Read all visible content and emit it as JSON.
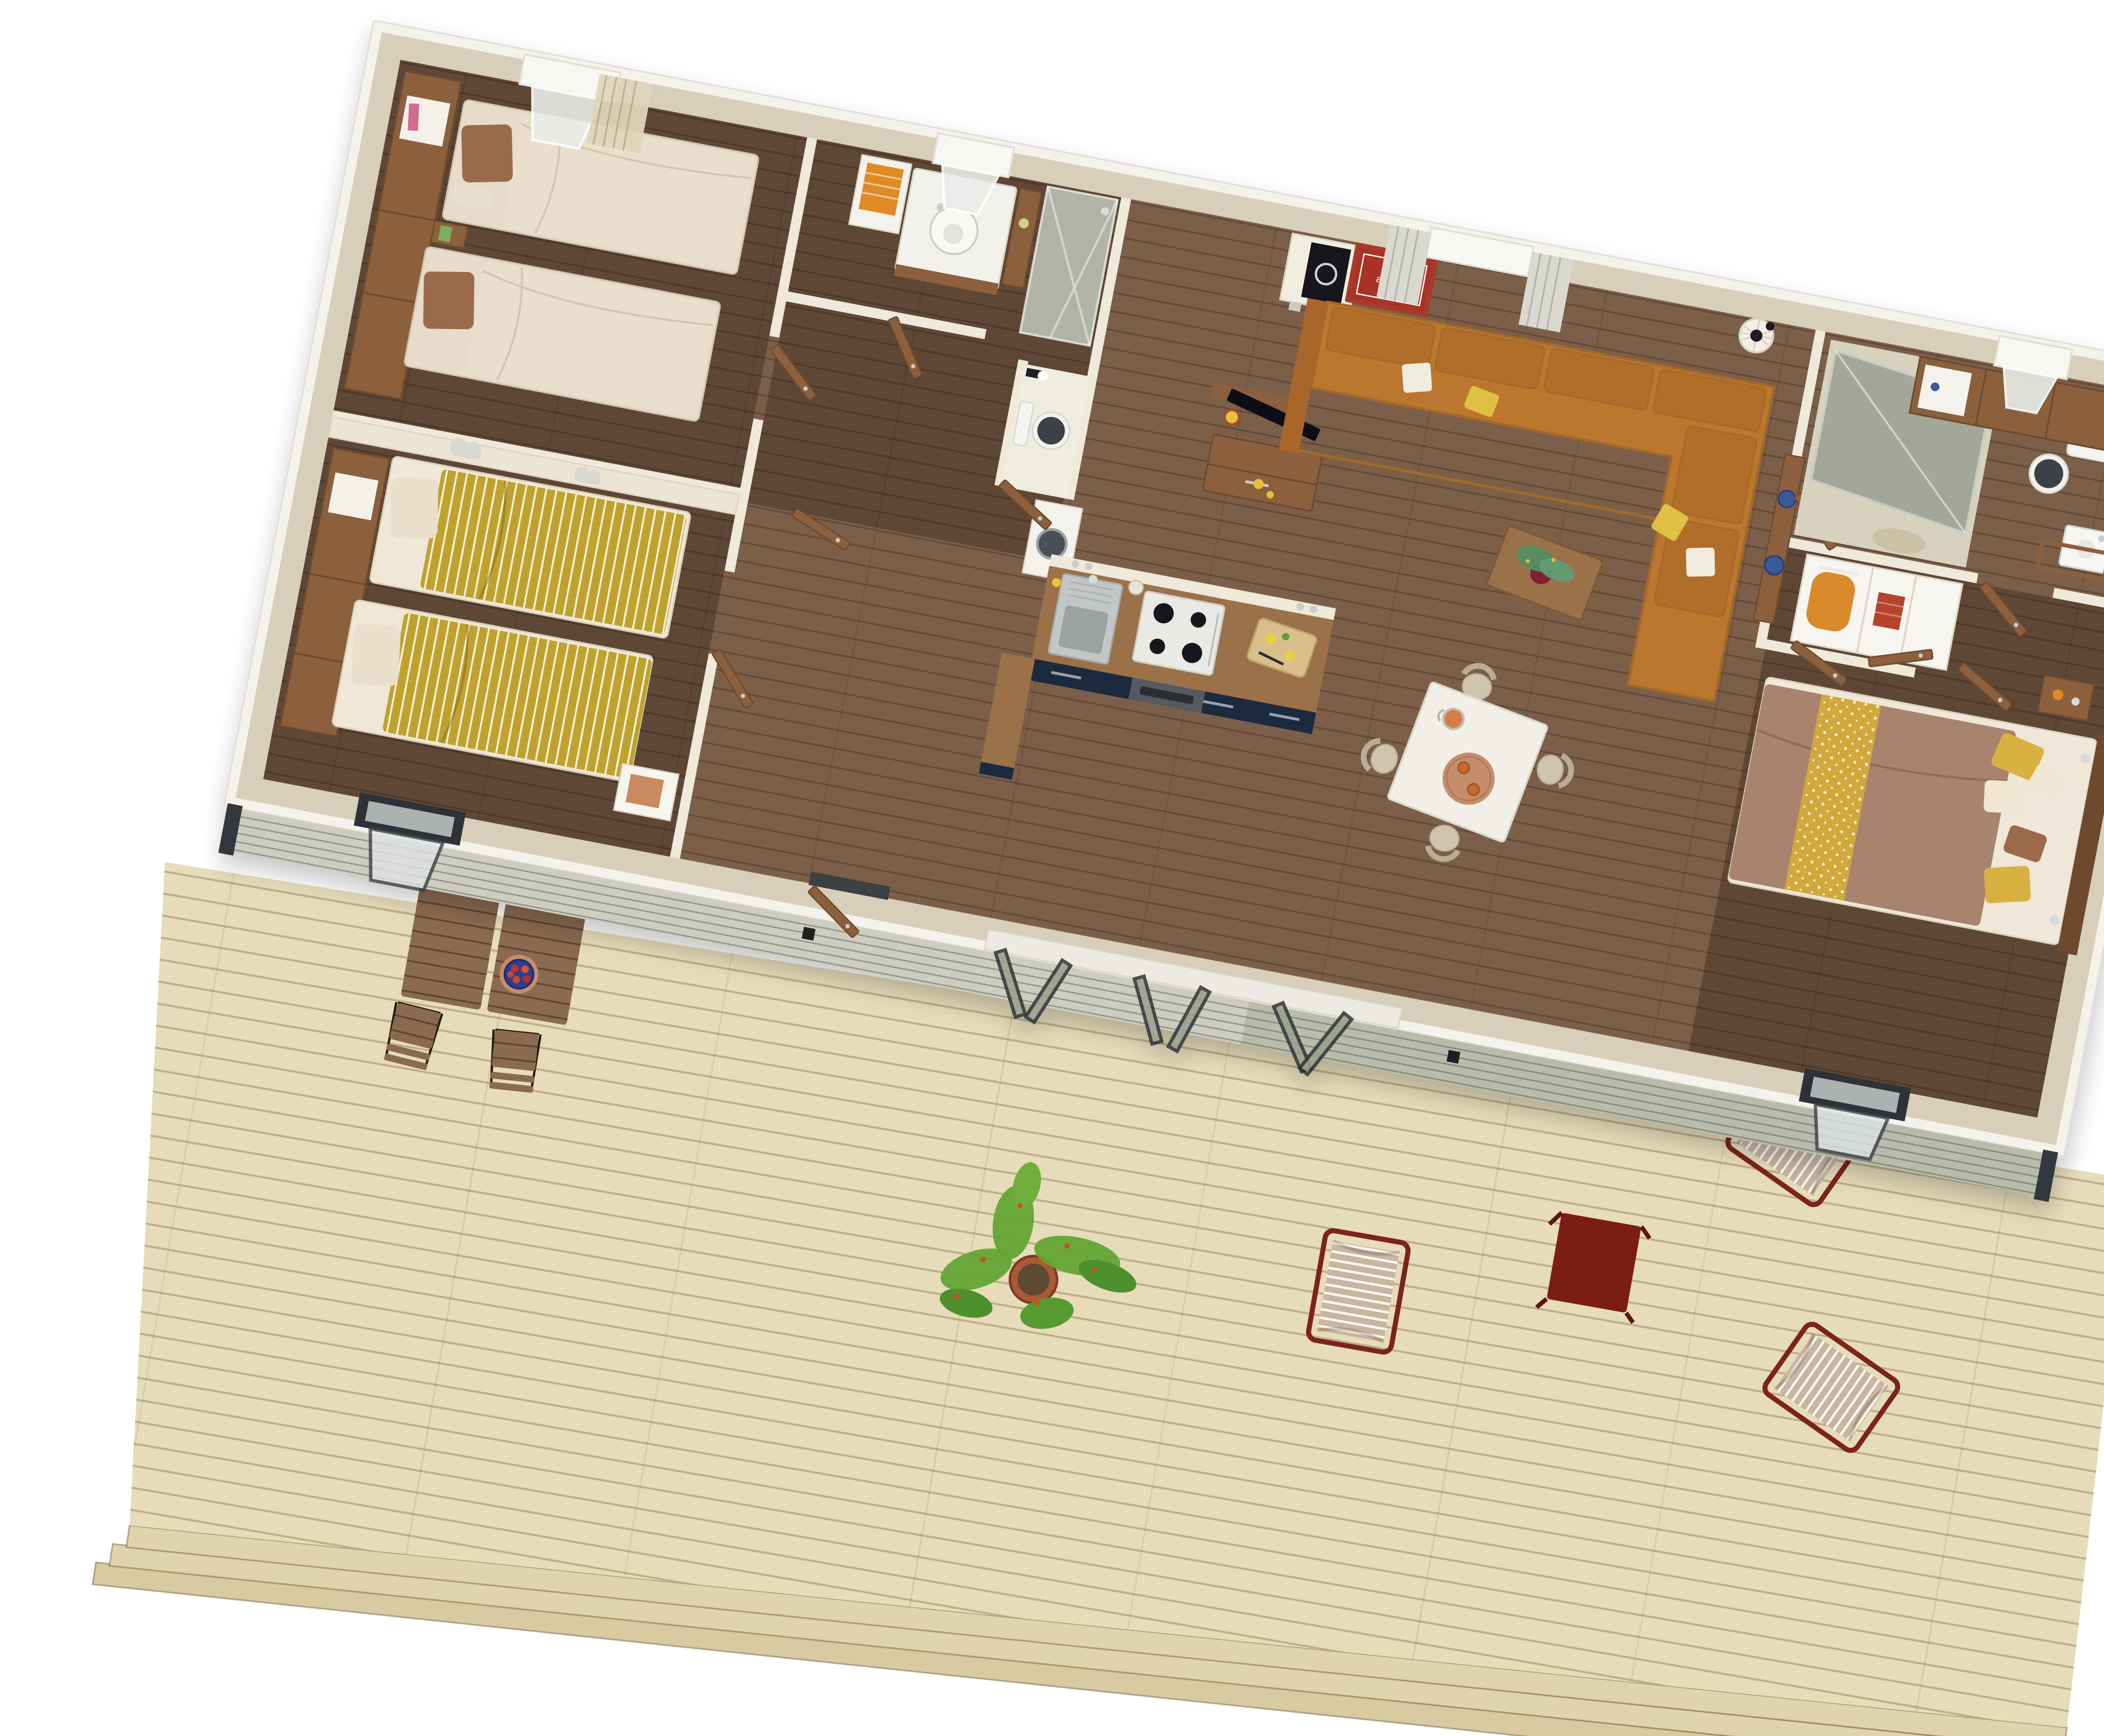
{
  "scene": {
    "type": "floorplan-3d-render",
    "description": "Top-down 3D render of a holiday mobile home with three bedrooms, two shower rooms, open kitchen-living area, folding glass front doors and a large timber sun deck",
    "rotation_deg": 10.8
  },
  "art": {
    "text": "amour."
  },
  "palette": {
    "background": "#ffffff",
    "fascia": "#f4f2ea",
    "wall": "#d8cfba",
    "partition": "#efe9da",
    "floor_dark": "#5e4636",
    "floor_mid": "#7c5f49",
    "wood": "#8c5f3e",
    "wood_dark": "#6e4a2e",
    "navy": "#1e2b3c",
    "counter": "#9a7148",
    "sofa": "#bc772e",
    "cushion_white": "#f1ece0",
    "cushion_yellow": "#dfc043",
    "mustard": "#bfa22e",
    "cream_bedding": "#e6dcc9",
    "pillow_brown": "#9b6b4b",
    "master_duvet": "#a8836e",
    "master_throw": "#d2a83e",
    "mattress": "#efe8d8",
    "deck": "#e7dcba",
    "deck_step1": "#e0d4ae",
    "deck_step2": "#d8cba2",
    "deck_wood": "#8a6a50",
    "frame_dark": "#30343a",
    "glass": "#a9b0a0",
    "siding_light": "#cdcdc1",
    "siding_sage": "#b9bcab",
    "art_red": "#a93026",
    "burgundy": "#7c241c",
    "red_table": "#7c1d13",
    "lounger_fabric": "#c9b69f",
    "plant_green": "#63a434",
    "pot": "#ab5a36",
    "dining_table": "#f1efe8",
    "chair": "#cfc4ad",
    "tray": "#c68d6a",
    "bowl_blue": "#2c3f8f",
    "orange_towel": "#e08a28",
    "toilet_dark": "#3c4147",
    "shower_glass": "#b9beb0"
  },
  "semantics": {
    "rooms": [
      {
        "name": "twin-bedroom",
        "beds": 2
      },
      {
        "name": "kids-bedroom",
        "beds": 2
      },
      {
        "name": "shower-room",
        "fixtures": [
          "washbasin",
          "shower",
          "wc",
          "washing-machine"
        ]
      },
      {
        "name": "kitchen",
        "fixtures": [
          "sink",
          "gas-hob-4-burners",
          "oven"
        ]
      },
      {
        "name": "living-room",
        "furniture": [
          "corner-sofa",
          "coffee-table",
          "tv-unit",
          "pendant-lamp"
        ]
      },
      {
        "name": "dining-area",
        "furniture": [
          "square-table",
          "chairs"
        ],
        "chairs": 4
      },
      {
        "name": "hallway-wardrobe",
        "furniture": [
          "open-wardrobe"
        ]
      },
      {
        "name": "bathroom-2",
        "fixtures": [
          "shower",
          "wc",
          "washbasin"
        ]
      },
      {
        "name": "master-bedroom",
        "beds": 1
      },
      {
        "name": "terrace",
        "furniture": [
          "slatted-tables",
          "bistro-chairs",
          "potted-plant",
          "sling-loungers",
          "red-side-table"
        ],
        "bistro_chairs": 4,
        "loungers": 3
      }
    ]
  }
}
